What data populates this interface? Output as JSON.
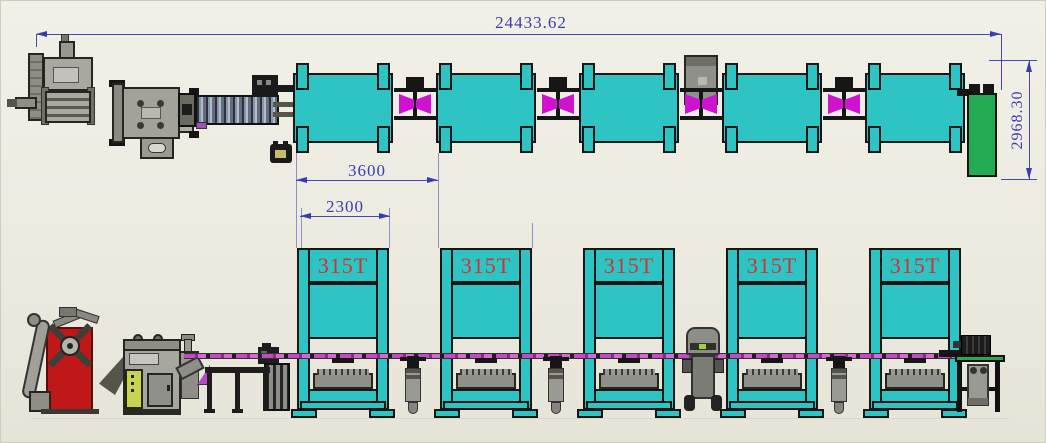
{
  "drawing_title": "stamping-press-line-layout",
  "dimensions": {
    "total_length": "24433.62",
    "line_height": "2968.30",
    "press_pitch": "3600",
    "press_width": "2300"
  },
  "press_labels": [
    "315T",
    "315T",
    "315T",
    "315T",
    "315T"
  ],
  "colors": {
    "background": "#edebe0",
    "press_cyan": "#2fc4c4",
    "transfer_magenta": "#cf12cf",
    "dimension_blue": "#3b3bb0",
    "press_label_red": "#d43030",
    "end_block_green": "#22ab52",
    "decoiler_red": "#c01818",
    "control_panel_yellow": "#c9d44e",
    "machinery_gray": "#9a9a94"
  },
  "icons": {
    "decoiler": "css-shape",
    "straightener-feeder": "css-shape",
    "roller-conveyor": "css-shape",
    "press-plan": "css-shape",
    "press-elevation": "css-shape",
    "transfer-station": "css-shape",
    "robot-controller": "css-shape",
    "pedestal-robot": "css-shape",
    "mobile-robot": "css-shape",
    "end-stacker": "css-shape",
    "control-pendant": "css-shape"
  }
}
